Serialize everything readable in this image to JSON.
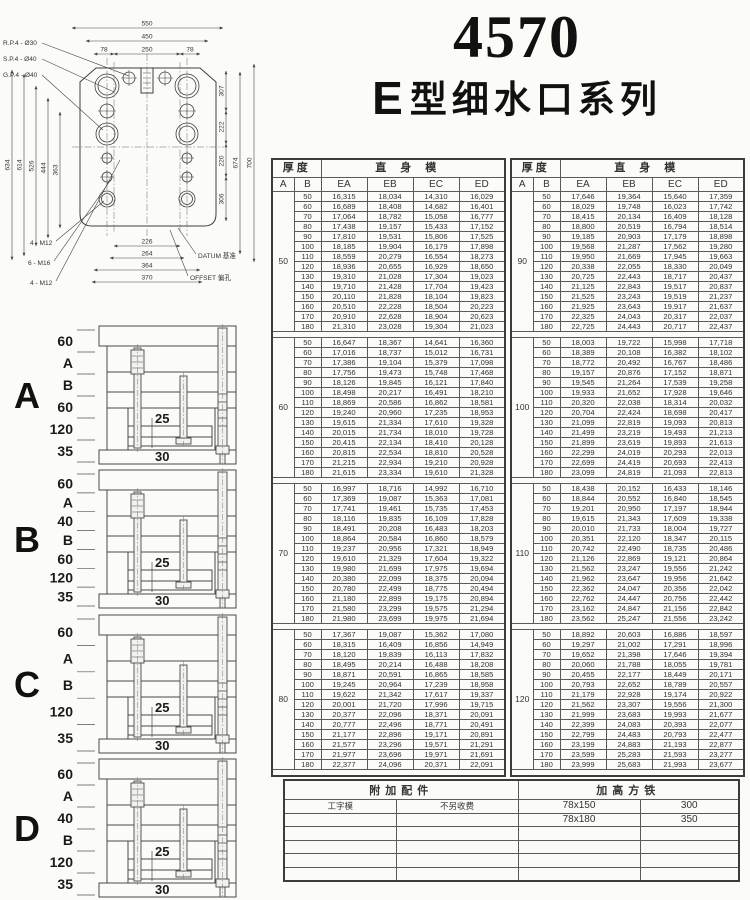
{
  "title": {
    "model": "4570",
    "series_letter": "E",
    "series_text": "型细水口系列"
  },
  "drawing": {
    "leader_rp": "R.P.4 - Ø30",
    "leader_sp": "S.P.4 - Ø40",
    "leader_gp": "G.P.4 - Ø40",
    "leader_m12a": "4 - M12",
    "leader_m16": "6 - M16",
    "leader_m12b": "4 - M12",
    "datum": "DATUM 基准",
    "offset": "OFFSET 偏孔",
    "dim_550": "550",
    "dim_450": "450",
    "dim_78a": "78",
    "dim_250": "250",
    "dim_78b": "78",
    "dim_634": "634",
    "dim_614": "614",
    "dim_526": "526",
    "dim_444": "444",
    "dim_363": "363",
    "dim_307": "307",
    "dim_222": "222",
    "dim_220": "220",
    "dim_306": "306",
    "dim_674": "674",
    "dim_700": "700",
    "dim_226": "226",
    "dim_264": "264",
    "dim_364": "364",
    "dim_370": "370"
  },
  "diagrams": [
    {
      "letter": "A",
      "dims": [
        "60",
        "A",
        "B",
        "60",
        "120",
        "35"
      ],
      "dim_25": "25",
      "dim_30": "30"
    },
    {
      "letter": "B",
      "dims": [
        "60",
        "A",
        "40",
        "B",
        "60",
        "120",
        "35"
      ],
      "dim_25": "25",
      "dim_30": "30"
    },
    {
      "letter": "C",
      "dims": [
        "60",
        "A",
        "B",
        "120",
        "35"
      ],
      "dim_25": "25",
      "dim_30": "30"
    },
    {
      "letter": "D",
      "dims": [
        "60",
        "A",
        "40",
        "B",
        "120",
        "35"
      ],
      "dim_25": "25",
      "dim_30": "30"
    }
  ],
  "price_table": {
    "thickness_label": "厚度",
    "straight_label": "直身模",
    "col_a": "A",
    "col_b": "B",
    "columns": [
      "EA",
      "EB",
      "EC",
      "ED"
    ],
    "left_blocks": [
      {
        "A": "50",
        "rows": [
          [
            "50",
            "16,315",
            "18,034",
            "14,310",
            "16,029"
          ],
          [
            "60",
            "16,689",
            "18,408",
            "14,682",
            "16,401"
          ],
          [
            "70",
            "17,064",
            "18,782",
            "15,058",
            "16,777"
          ],
          [
            "80",
            "17,438",
            "19,157",
            "15,433",
            "17,152"
          ],
          [
            "90",
            "17,810",
            "19,531",
            "15,806",
            "17,525"
          ],
          [
            "100",
            "18,185",
            "19,904",
            "16,179",
            "17,898"
          ],
          [
            "110",
            "18,559",
            "20,279",
            "16,554",
            "18,273"
          ],
          [
            "120",
            "18,936",
            "20,655",
            "16,929",
            "18,650"
          ],
          [
            "130",
            "19,310",
            "21,028",
            "17,304",
            "19,023"
          ],
          [
            "140",
            "19,710",
            "21,428",
            "17,704",
            "19,423"
          ],
          [
            "150",
            "20,110",
            "21,828",
            "18,104",
            "19,823"
          ],
          [
            "160",
            "20,510",
            "22,228",
            "18,504",
            "20,223"
          ],
          [
            "170",
            "20,910",
            "22,628",
            "18,904",
            "20,623"
          ],
          [
            "180",
            "21,310",
            "23,028",
            "19,304",
            "21,023"
          ]
        ]
      },
      {
        "A": "60",
        "rows": [
          [
            "50",
            "16,647",
            "18,367",
            "14,641",
            "16,360"
          ],
          [
            "60",
            "17,016",
            "18,737",
            "15,012",
            "16,731"
          ],
          [
            "70",
            "17,386",
            "19,104",
            "15,379",
            "17,098"
          ],
          [
            "80",
            "17,756",
            "19,473",
            "15,748",
            "17,468"
          ],
          [
            "90",
            "18,126",
            "19,845",
            "16,121",
            "17,840"
          ],
          [
            "100",
            "18,498",
            "20,217",
            "16,491",
            "18,210"
          ],
          [
            "110",
            "18,869",
            "20,586",
            "16,862",
            "18,581"
          ],
          [
            "120",
            "19,240",
            "20,960",
            "17,235",
            "18,953"
          ],
          [
            "130",
            "19,615",
            "21,334",
            "17,610",
            "19,328"
          ],
          [
            "140",
            "20,015",
            "21,734",
            "18,010",
            "19,728"
          ],
          [
            "150",
            "20,415",
            "22,134",
            "18,410",
            "20,128"
          ],
          [
            "160",
            "20,815",
            "22,534",
            "18,810",
            "20,528"
          ],
          [
            "170",
            "21,215",
            "22,934",
            "19,210",
            "20,928"
          ],
          [
            "180",
            "21,615",
            "23,334",
            "19,610",
            "21,328"
          ]
        ]
      },
      {
        "A": "70",
        "rows": [
          [
            "50",
            "16,997",
            "18,716",
            "14,992",
            "16,710"
          ],
          [
            "60",
            "17,369",
            "19,087",
            "15,363",
            "17,081"
          ],
          [
            "70",
            "17,741",
            "19,461",
            "15,735",
            "17,453"
          ],
          [
            "80",
            "18,116",
            "19,835",
            "16,109",
            "17,828"
          ],
          [
            "90",
            "18,491",
            "20,208",
            "16,483",
            "18,203"
          ],
          [
            "100",
            "18,864",
            "20,584",
            "16,860",
            "18,579"
          ],
          [
            "110",
            "19,237",
            "20,956",
            "17,321",
            "18,949"
          ],
          [
            "120",
            "19,610",
            "21,329",
            "17,604",
            "19,322"
          ],
          [
            "130",
            "19,980",
            "21,699",
            "17,975",
            "19,694"
          ],
          [
            "140",
            "20,380",
            "22,099",
            "18,375",
            "20,094"
          ],
          [
            "150",
            "20,780",
            "22,499",
            "18,775",
            "20,494"
          ],
          [
            "160",
            "21,180",
            "22,899",
            "19,175",
            "20,894"
          ],
          [
            "170",
            "21,580",
            "23,299",
            "19,575",
            "21,294"
          ],
          [
            "180",
            "21,980",
            "23,699",
            "19,975",
            "21,694"
          ]
        ]
      },
      {
        "A": "80",
        "rows": [
          [
            "50",
            "17,367",
            "19,087",
            "15,362",
            "17,080"
          ],
          [
            "60",
            "18,315",
            "16,409",
            "16,856",
            "14,949"
          ],
          [
            "70",
            "18,120",
            "19,839",
            "16,113",
            "17,832"
          ],
          [
            "80",
            "18,495",
            "20,214",
            "16,488",
            "18,208"
          ],
          [
            "90",
            "18,871",
            "20,591",
            "16,865",
            "18,585"
          ],
          [
            "100",
            "19,245",
            "20,964",
            "17,239",
            "18,958"
          ],
          [
            "110",
            "19,622",
            "21,342",
            "17,617",
            "19,337"
          ],
          [
            "120",
            "20,001",
            "21,720",
            "17,996",
            "19,715"
          ],
          [
            "130",
            "20,377",
            "22,096",
            "18,371",
            "20,091"
          ],
          [
            "140",
            "20,777",
            "22,496",
            "18,771",
            "20,491"
          ],
          [
            "150",
            "21,177",
            "22,896",
            "19,171",
            "20,891"
          ],
          [
            "160",
            "21,577",
            "23,296",
            "19,571",
            "21,291"
          ],
          [
            "170",
            "21,977",
            "23,696",
            "19,971",
            "21,691"
          ],
          [
            "180",
            "22,377",
            "24,096",
            "20,371",
            "22,091"
          ]
        ]
      }
    ],
    "right_blocks": [
      {
        "A": "90",
        "rows": [
          [
            "50",
            "17,646",
            "19,364",
            "15,640",
            "17,359"
          ],
          [
            "60",
            "18,029",
            "19,748",
            "16,023",
            "17,742"
          ],
          [
            "70",
            "18,415",
            "20,134",
            "16,409",
            "18,128"
          ],
          [
            "80",
            "18,800",
            "20,519",
            "16,794",
            "18,514"
          ],
          [
            "90",
            "19,185",
            "20,903",
            "17,179",
            "18,898"
          ],
          [
            "100",
            "19,568",
            "21,287",
            "17,562",
            "19,280"
          ],
          [
            "110",
            "19,950",
            "21,669",
            "17,945",
            "19,663"
          ],
          [
            "120",
            "20,338",
            "22,055",
            "18,330",
            "20,049"
          ],
          [
            "130",
            "20,725",
            "22,443",
            "18,717",
            "20,437"
          ],
          [
            "140",
            "21,125",
            "22,843",
            "19,517",
            "20,837"
          ],
          [
            "150",
            "21,525",
            "23,243",
            "19,519",
            "21,237"
          ],
          [
            "160",
            "21,925",
            "23,643",
            "19,917",
            "21,637"
          ],
          [
            "170",
            "22,325",
            "24,043",
            "20,317",
            "22,037"
          ],
          [
            "180",
            "22,725",
            "24,443",
            "20,717",
            "22,437"
          ]
        ]
      },
      {
        "A": "100",
        "rows": [
          [
            "50",
            "18,003",
            "19,722",
            "15,998",
            "17,718"
          ],
          [
            "60",
            "18,389",
            "20,108",
            "16,382",
            "18,102"
          ],
          [
            "70",
            "18,772",
            "20,492",
            "16,767",
            "18,486"
          ],
          [
            "80",
            "19,157",
            "20,876",
            "17,152",
            "18,871"
          ],
          [
            "90",
            "19,545",
            "21,264",
            "17,539",
            "19,258"
          ],
          [
            "100",
            "19,933",
            "21,652",
            "17,928",
            "19,646"
          ],
          [
            "110",
            "20,320",
            "22,038",
            "18,314",
            "20,032"
          ],
          [
            "120",
            "20,704",
            "22,424",
            "18,698",
            "20,417"
          ],
          [
            "130",
            "21,099",
            "22,819",
            "19,093",
            "20,813"
          ],
          [
            "140",
            "21,499",
            "23,219",
            "19,493",
            "21,213"
          ],
          [
            "150",
            "21,899",
            "23,619",
            "19,893",
            "21,613"
          ],
          [
            "160",
            "22,299",
            "24,019",
            "20,293",
            "22,013"
          ],
          [
            "170",
            "22,699",
            "24,419",
            "20,693",
            "22,413"
          ],
          [
            "180",
            "23,099",
            "24,819",
            "21,093",
            "22,813"
          ]
        ]
      },
      {
        "A": "110",
        "rows": [
          [
            "50",
            "18,438",
            "20,152",
            "16,433",
            "18,146"
          ],
          [
            "60",
            "18,844",
            "20,552",
            "16,840",
            "18,545"
          ],
          [
            "70",
            "19,201",
            "20,950",
            "17,197",
            "18,944"
          ],
          [
            "80",
            "19,615",
            "21,343",
            "17,609",
            "19,338"
          ],
          [
            "90",
            "20,010",
            "21,733",
            "18,004",
            "19,727"
          ],
          [
            "100",
            "20,351",
            "22,120",
            "18,347",
            "20,115"
          ],
          [
            "110",
            "20,742",
            "22,490",
            "18,735",
            "20,486"
          ],
          [
            "120",
            "21,126",
            "22,869",
            "19,121",
            "20,864"
          ],
          [
            "130",
            "21,562",
            "23,247",
            "19,556",
            "21,242"
          ],
          [
            "140",
            "21,962",
            "23,647",
            "19,956",
            "21,642"
          ],
          [
            "150",
            "22,362",
            "24,047",
            "20,356",
            "22,042"
          ],
          [
            "160",
            "22,762",
            "24,447",
            "20,756",
            "22,442"
          ],
          [
            "170",
            "23,162",
            "24,847",
            "21,156",
            "22,842"
          ],
          [
            "180",
            "23,562",
            "25,247",
            "21,556",
            "23,242"
          ]
        ]
      },
      {
        "A": "120",
        "rows": [
          [
            "50",
            "18,892",
            "20,603",
            "16,886",
            "18,597"
          ],
          [
            "60",
            "19,297",
            "21,002",
            "17,291",
            "18,996"
          ],
          [
            "70",
            "19,652",
            "21,398",
            "17,646",
            "19,394"
          ],
          [
            "80",
            "20,060",
            "21,788",
            "18,055",
            "19,781"
          ],
          [
            "90",
            "20,455",
            "22,177",
            "18,449",
            "20,171"
          ],
          [
            "100",
            "20,793",
            "22,652",
            "18,789",
            "20,557"
          ],
          [
            "110",
            "21,179",
            "22,928",
            "19,174",
            "20,922"
          ],
          [
            "120",
            "21,562",
            "23,307",
            "19,556",
            "21,300"
          ],
          [
            "130",
            "21,999",
            "23,683",
            "19,993",
            "21,677"
          ],
          [
            "140",
            "22,399",
            "24,083",
            "20,393",
            "22,077"
          ],
          [
            "150",
            "22,799",
            "24,483",
            "20,793",
            "22,477"
          ],
          [
            "160",
            "23,199",
            "24,883",
            "21,193",
            "22,877"
          ],
          [
            "170",
            "23,599",
            "25,283",
            "21,593",
            "23,277"
          ],
          [
            "180",
            "23,999",
            "25,683",
            "21,993",
            "23,677"
          ]
        ]
      }
    ]
  },
  "accessory_table": {
    "header_left": "附加配件",
    "header_right": "加高方铁",
    "rows": [
      [
        "工字模",
        "不另收费",
        "78x150",
        "300"
      ],
      [
        "",
        "",
        "78x180",
        "350"
      ],
      [
        "",
        "",
        "",
        ""
      ],
      [
        "",
        "",
        "",
        ""
      ],
      [
        "",
        "",
        "",
        ""
      ],
      [
        "",
        "",
        "",
        ""
      ]
    ]
  }
}
